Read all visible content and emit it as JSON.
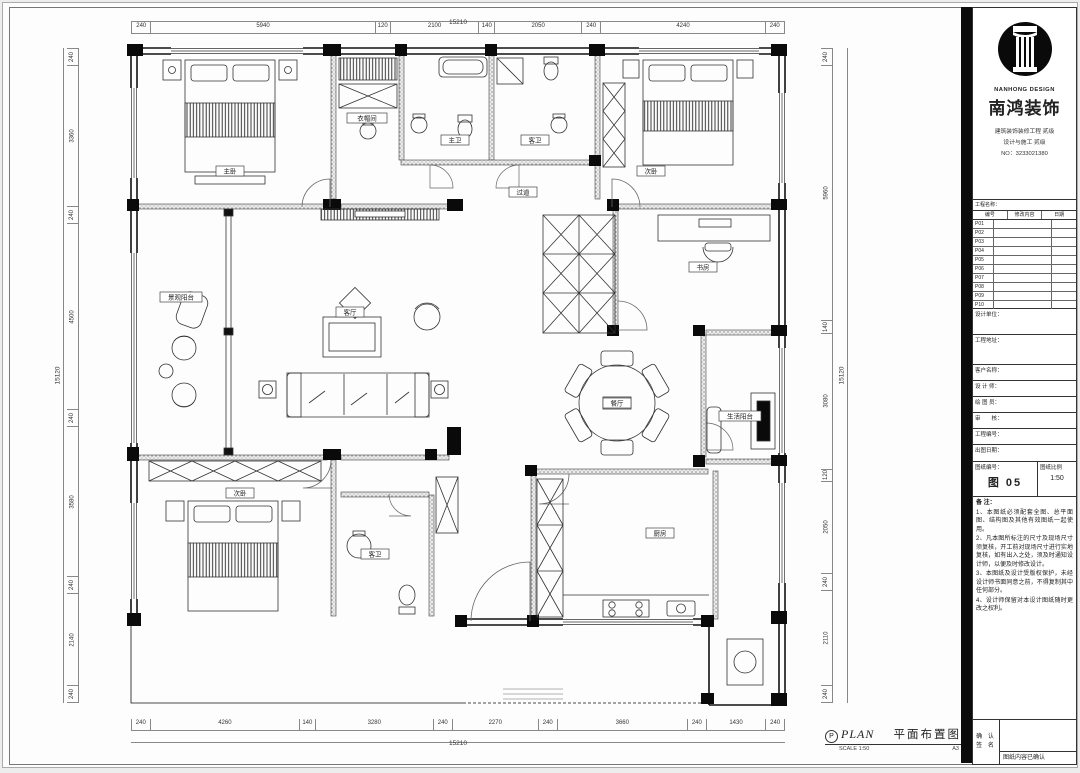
{
  "title_block": {
    "logo_en": "NANHONG DESIGN",
    "logo_cn": "南鸿装饰",
    "cert_lines": [
      "建筑装饰装修工程 贰级",
      "设计与施工 贰级",
      "NO：3233021380"
    ],
    "revision": {
      "title": "工程名称：",
      "header": [
        "编号",
        "修改内容",
        "日期"
      ],
      "rows": [
        "P01",
        "P02",
        "P03",
        "P04",
        "P05",
        "P06",
        "P07",
        "P08",
        "P09",
        "P10"
      ]
    },
    "boxes": [
      {
        "label": "设计单位："
      },
      {
        "label": "工程地址："
      }
    ],
    "fields": [
      {
        "label": "客户名称："
      },
      {
        "label": "设 计 师："
      },
      {
        "label": "绘 图 员："
      },
      {
        "label": "审　　核："
      },
      {
        "label": "工程编号："
      },
      {
        "label": "出图日期："
      }
    ],
    "drawing_no_label": "图纸编号：",
    "drawing_no": "图 05",
    "scale_label": "图纸比例",
    "scale_value": "1:50",
    "notes_title": "备 注：",
    "notes": [
      "1、本图纸必须配套全图、总平面图、结构图及其他有效图纸一起使用。",
      "2、凡本图所标注的尺寸及现场尺寸须复核，开工前对现场尺寸进行实地复核，如有出入之处，须及时通知设计师，以便及时修改设计。",
      "3、本图纸及设计受版权保护，未经设计师书面同意之前，不得复制其中任何部分。",
      "4、设计师保留对本设计图纸随时更改之权利。"
    ],
    "confirm_label_1": "确 认",
    "confirm_label_2": "签 名",
    "confirm_note": "图纸内容已确认"
  },
  "plan_caption": {
    "marker": "P",
    "title_en": "PLAN",
    "title_cn": "平面布置图",
    "scale": "SCALE 1:50",
    "sheet": "A3"
  },
  "dimensions": {
    "top": {
      "total": "15210",
      "segments": [
        "240",
        "5940",
        "120",
        "2100",
        "140",
        "2050",
        "240",
        "4240",
        "240"
      ]
    },
    "bottom": {
      "total": "15210",
      "segments": [
        "240",
        "4260",
        "140",
        "3280",
        "240",
        "2270",
        "240",
        "3660",
        "240",
        "1430",
        "240"
      ]
    },
    "left": {
      "total": "15120",
      "segments": [
        "240",
        "3360",
        "240",
        "4500",
        "240",
        "3580",
        "240",
        "2140",
        "240"
      ]
    },
    "right": {
      "total": "15120",
      "segments": [
        "240",
        "5960",
        "140",
        "3080",
        "120",
        "2050",
        "240",
        "2110",
        "240"
      ]
    }
  },
  "rooms": [
    {
      "name": "主卧"
    },
    {
      "name": "衣帽间"
    },
    {
      "name": "主卫"
    },
    {
      "name": "客卫"
    },
    {
      "name": "次卧"
    },
    {
      "name": "过道"
    },
    {
      "name": "书房"
    },
    {
      "name": "景观阳台"
    },
    {
      "name": "客厅"
    },
    {
      "name": "餐厅"
    },
    {
      "name": "生活阳台"
    },
    {
      "name": "次卧"
    },
    {
      "name": "客卫"
    },
    {
      "name": "厨房"
    }
  ]
}
